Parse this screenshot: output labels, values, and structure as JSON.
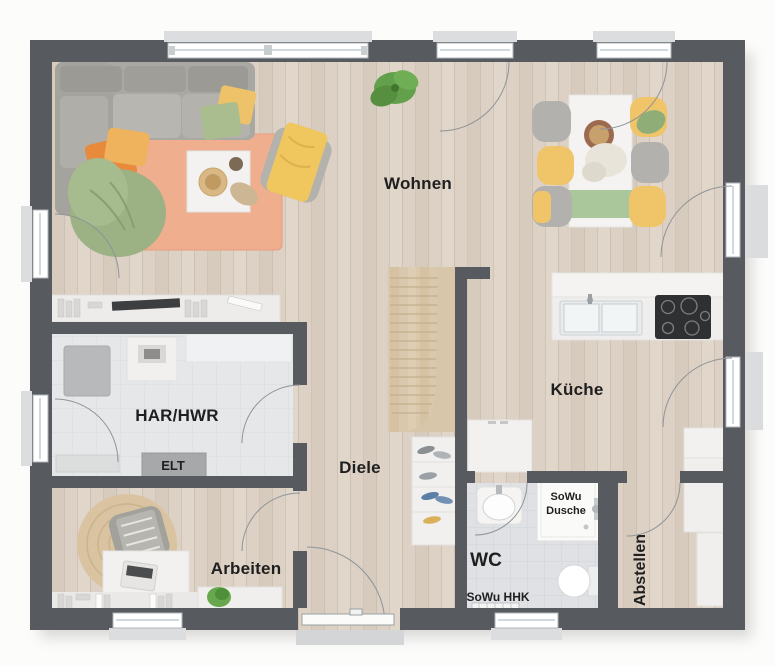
{
  "plan": {
    "type": "floor-plan",
    "rooms": {
      "wohnen": {
        "label": "Wohnen"
      },
      "kueche": {
        "label": "Küche"
      },
      "har_hwr": {
        "label": "HAR/HWR"
      },
      "elt": {
        "label": "ELT"
      },
      "diele": {
        "label": "Diele"
      },
      "arbeiten": {
        "label": "Arbeiten"
      },
      "wc": {
        "label": "WC"
      },
      "dusche": {
        "line1": "SoWu",
        "line2": "Dusche"
      },
      "hhk": {
        "label": "SoWu HHK"
      },
      "abstellen": {
        "label": "Abstellen"
      }
    },
    "colors": {
      "wall": "#575a5e",
      "wood_floor": "#dcd1c4",
      "tile_floor": "#e6e7e9",
      "wc_tile": "#dfe1e4",
      "stair_wood": "#d9c8ab",
      "rug": "#efae8e",
      "jute_rug": "#d9c3a0",
      "accent_yellow": "#eec263",
      "accent_orange": "#e78a3c",
      "accent_green": "#9cb184",
      "furniture_white": "#f2f1ef",
      "sofa_gray": "#aaa8a3",
      "cooktop_black": "#2e3032",
      "window_frame": "#ffffff",
      "label_text": "#1f1f1f"
    }
  }
}
